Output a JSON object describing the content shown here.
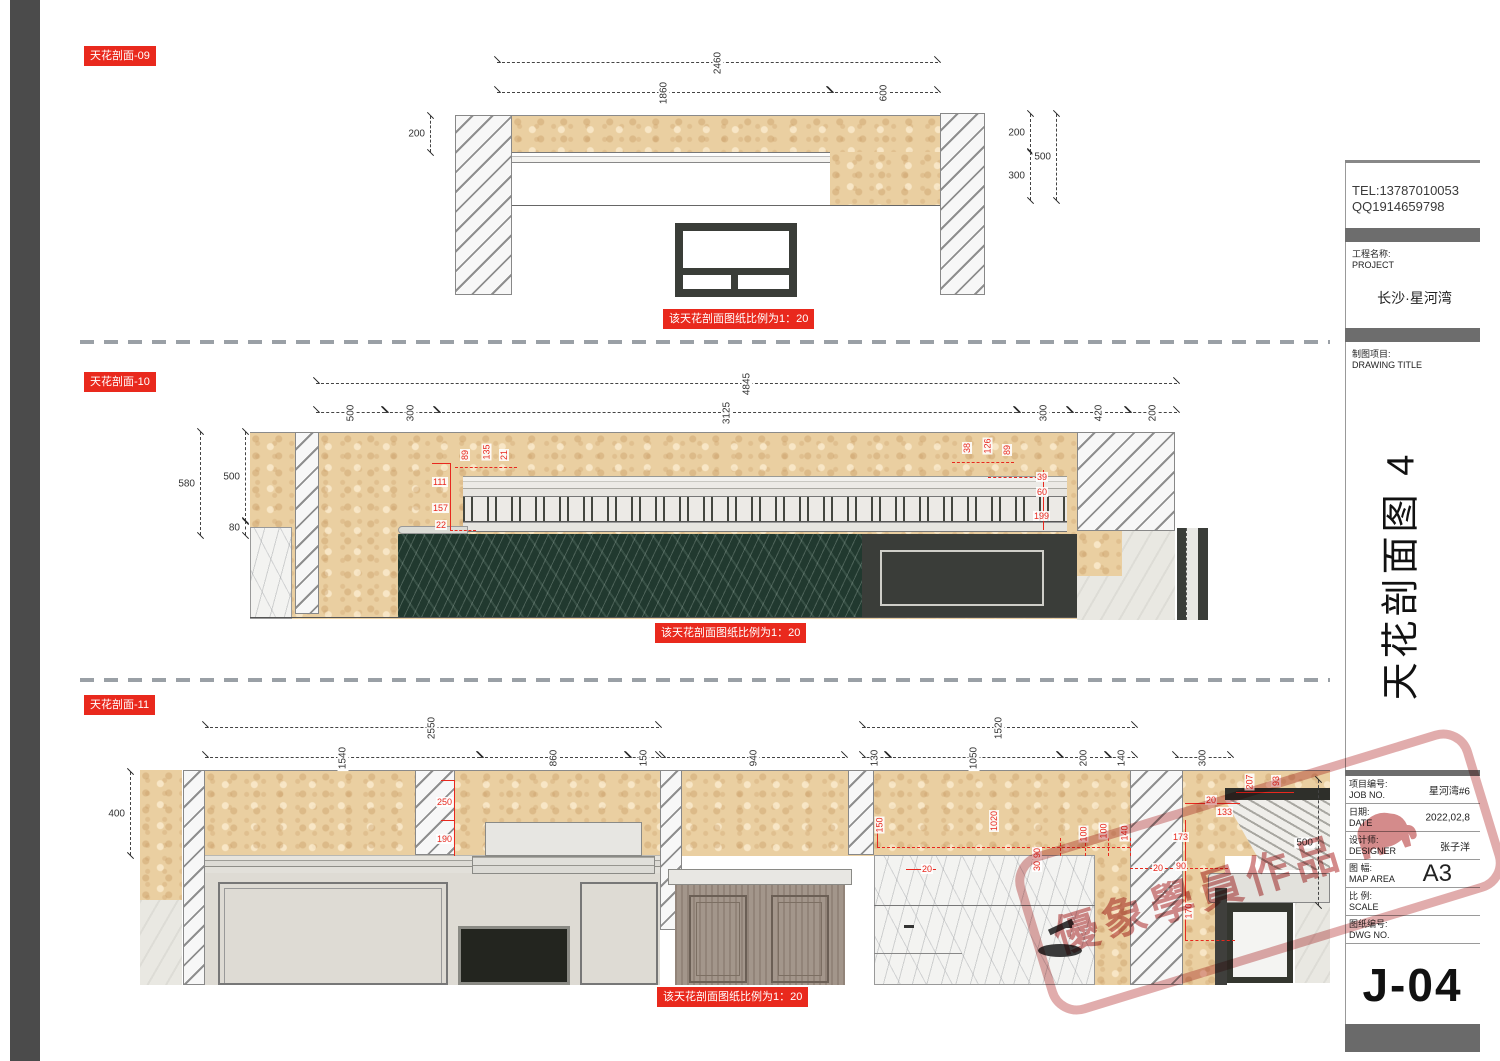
{
  "sheet": {
    "scale_note": "该天花剖面图纸比例为1：20",
    "section_labels": {
      "d09": "天花剖面-09",
      "d10": "天花剖面-10",
      "d11": "天花剖面-11"
    }
  },
  "titleblock": {
    "tel": "TEL:13787010053",
    "qq": "QQ1914659798",
    "project_label_cn": "工程名称:",
    "project_label_en": "PROJECT",
    "project_name": "长沙·星河湾",
    "drawing_label_cn": "制图项目:",
    "drawing_label_en": "DRAWING TITLE",
    "sheet_title": "天花剖面图 4",
    "rows": [
      {
        "cn": "项目编号:",
        "en": "JOB NO.",
        "value": "星河湾#6"
      },
      {
        "cn": "日期:",
        "en": "DATE",
        "value": "2022,02,8"
      },
      {
        "cn": "设计师:",
        "en": "DESIGNER",
        "value": "张子洋"
      },
      {
        "cn": "图 幅:",
        "en": "MAP AREA",
        "value": "A3",
        "big": true
      },
      {
        "cn": "比 例:",
        "en": "SCALE",
        "value": ""
      },
      {
        "cn": "图纸编号:",
        "en": "DWG NO.",
        "value": ""
      }
    ],
    "sheet_no": "J-04"
  },
  "watermark": {
    "text": "優象學員作品",
    "icon": "elephant-icon"
  },
  "dimensions": [
    {
      "t": "2460",
      "o": "h",
      "x": 497,
      "y": 62,
      "l": 441,
      "r": 1
    },
    {
      "t": "1860",
      "o": "h",
      "x": 497,
      "y": 92,
      "l": 333,
      "r": 1
    },
    {
      "t": "600",
      "o": "h",
      "x": 830,
      "y": 92,
      "l": 108,
      "r": 1
    },
    {
      "t": "200",
      "o": "v",
      "x": 430,
      "y": 116,
      "l": 36
    },
    {
      "t": "200",
      "o": "v",
      "x": 1030,
      "y": 114,
      "l": 38
    },
    {
      "t": "300",
      "o": "v",
      "x": 1030,
      "y": 152,
      "l": 48
    },
    {
      "t": "500",
      "o": "v",
      "x": 1056,
      "y": 114,
      "l": 86
    },
    {
      "t": "4845",
      "o": "h",
      "x": 316,
      "y": 383,
      "l": 861,
      "r": 1
    },
    {
      "t": "500",
      "o": "h",
      "x": 316,
      "y": 412,
      "l": 69,
      "r": 1
    },
    {
      "t": "300",
      "o": "h",
      "x": 385,
      "y": 412,
      "l": 52,
      "r": 1
    },
    {
      "t": "3125",
      "o": "h",
      "x": 437,
      "y": 412,
      "l": 580,
      "r": 1
    },
    {
      "t": "300",
      "o": "h",
      "x": 1017,
      "y": 412,
      "l": 53,
      "r": 1
    },
    {
      "t": "420",
      "o": "h",
      "x": 1070,
      "y": 412,
      "l": 58,
      "r": 1
    },
    {
      "t": "200",
      "o": "h",
      "x": 1128,
      "y": 412,
      "l": 49,
      "r": 1
    },
    {
      "t": "580",
      "o": "v",
      "x": 200,
      "y": 432,
      "l": 103
    },
    {
      "t": "500",
      "o": "v",
      "x": 245,
      "y": 432,
      "l": 89
    },
    {
      "t": "80",
      "o": "v",
      "x": 245,
      "y": 521,
      "l": 14
    },
    {
      "t": "2550",
      "o": "h",
      "x": 205,
      "y": 727,
      "l": 454,
      "r": 1
    },
    {
      "t": "1520",
      "o": "h",
      "x": 862,
      "y": 727,
      "l": 273,
      "r": 1
    },
    {
      "t": "1540",
      "o": "h",
      "x": 205,
      "y": 757,
      "l": 275,
      "r": 1
    },
    {
      "t": "860",
      "o": "h",
      "x": 480,
      "y": 757,
      "l": 148,
      "r": 1
    },
    {
      "t": "150",
      "o": "h",
      "x": 628,
      "y": 757,
      "l": 31,
      "r": 1
    },
    {
      "t": "940",
      "o": "h",
      "x": 662,
      "y": 757,
      "l": 183,
      "r": 1
    },
    {
      "t": "130",
      "o": "h",
      "x": 862,
      "y": 757,
      "l": 26,
      "r": 1
    },
    {
      "t": "1050",
      "o": "h",
      "x": 888,
      "y": 757,
      "l": 172,
      "r": 1
    },
    {
      "t": "200",
      "o": "h",
      "x": 1060,
      "y": 757,
      "l": 48,
      "r": 1
    },
    {
      "t": "140",
      "o": "h",
      "x": 1108,
      "y": 757,
      "l": 27,
      "r": 1
    },
    {
      "t": "300",
      "o": "h",
      "x": 1175,
      "y": 757,
      "l": 56,
      "r": 1
    },
    {
      "t": "400",
      "o": "v",
      "x": 130,
      "y": 772,
      "l": 83
    },
    {
      "t": "500",
      "o": "v",
      "x": 1318,
      "y": 780,
      "l": 125
    }
  ],
  "red_labels": [
    {
      "t": "89",
      "x": 459,
      "y": 450,
      "r": 1
    },
    {
      "t": "135",
      "x": 478,
      "y": 447,
      "r": 1
    },
    {
      "t": "21",
      "x": 498,
      "y": 450,
      "r": 1
    },
    {
      "t": "111",
      "x": 432,
      "y": 477
    },
    {
      "t": "157",
      "x": 432,
      "y": 503
    },
    {
      "t": "22",
      "x": 435,
      "y": 520
    },
    {
      "t": "38",
      "x": 961,
      "y": 443,
      "r": 1
    },
    {
      "t": "126",
      "x": 979,
      "y": 441,
      "r": 1
    },
    {
      "t": "89",
      "x": 1001,
      "y": 445,
      "r": 1
    },
    {
      "t": "39",
      "x": 1036,
      "y": 472
    },
    {
      "t": "60",
      "x": 1036,
      "y": 487
    },
    {
      "t": "199",
      "x": 1033,
      "y": 511
    },
    {
      "t": "250",
      "x": 436,
      "y": 797
    },
    {
      "t": "190",
      "x": 436,
      "y": 834
    },
    {
      "t": "150",
      "x": 871,
      "y": 820,
      "r": 1
    },
    {
      "t": "1020",
      "x": 983,
      "y": 816,
      "r": 1
    },
    {
      "t": "20",
      "x": 921,
      "y": 864
    },
    {
      "t": "90",
      "x": 1031,
      "y": 848,
      "r": 1
    },
    {
      "t": "30",
      "x": 1031,
      "y": 861,
      "r": 1
    },
    {
      "t": "100",
      "x": 1075,
      "y": 829,
      "r": 1
    },
    {
      "t": "100",
      "x": 1095,
      "y": 826,
      "r": 1
    },
    {
      "t": "140",
      "x": 1116,
      "y": 828,
      "r": 1
    },
    {
      "t": "20",
      "x": 1152,
      "y": 863
    },
    {
      "t": "20",
      "x": 1205,
      "y": 795
    },
    {
      "t": "133",
      "x": 1216,
      "y": 807
    },
    {
      "t": "173",
      "x": 1172,
      "y": 832
    },
    {
      "t": "90",
      "x": 1175,
      "y": 861
    },
    {
      "t": "170",
      "x": 1180,
      "y": 906,
      "r": 1
    },
    {
      "t": "207",
      "x": 1241,
      "y": 777,
      "r": 1
    },
    {
      "t": "93",
      "x": 1270,
      "y": 776,
      "r": 1
    }
  ],
  "red_lines": [
    {
      "x": 450,
      "y": 463,
      "w": 1,
      "h": 68
    },
    {
      "x": 432,
      "y": 463,
      "w": 19,
      "h": 1
    },
    {
      "x": 450,
      "y": 530,
      "w": 26,
      "h": 1,
      "d": 1
    },
    {
      "x": 455,
      "y": 467,
      "w": 62,
      "h": 1,
      "d": 1
    },
    {
      "x": 952,
      "y": 462,
      "w": 62,
      "h": 1,
      "d": 1
    },
    {
      "x": 1043,
      "y": 470,
      "w": 1,
      "h": 60
    },
    {
      "x": 988,
      "y": 477,
      "w": 55,
      "h": 1,
      "d": 1
    },
    {
      "x": 454,
      "y": 780,
      "w": 1,
      "h": 76
    },
    {
      "x": 441,
      "y": 780,
      "w": 14,
      "h": 1
    },
    {
      "x": 441,
      "y": 820,
      "w": 14,
      "h": 1
    },
    {
      "x": 877,
      "y": 824,
      "w": 1,
      "h": 23
    },
    {
      "x": 877,
      "y": 847,
      "w": 253,
      "h": 1,
      "d": 1
    },
    {
      "x": 906,
      "y": 869,
      "w": 30,
      "h": 1
    },
    {
      "x": 1185,
      "y": 820,
      "w": 1,
      "h": 120
    },
    {
      "x": 1130,
      "y": 868,
      "w": 98,
      "h": 1,
      "d": 1
    },
    {
      "x": 1185,
      "y": 803,
      "w": 55,
      "h": 1
    },
    {
      "x": 1185,
      "y": 940,
      "w": 50,
      "h": 1,
      "d": 1
    },
    {
      "x": 1236,
      "y": 792,
      "w": 58,
      "h": 1
    },
    {
      "x": 1060,
      "y": 838,
      "w": 1,
      "h": 18,
      "d": 1
    },
    {
      "x": 1085,
      "y": 838,
      "w": 1,
      "h": 18,
      "d": 1
    },
    {
      "x": 1108,
      "y": 838,
      "w": 1,
      "h": 18,
      "d": 1
    },
    {
      "x": 1130,
      "y": 838,
      "w": 1,
      "h": 18,
      "d": 1
    }
  ]
}
